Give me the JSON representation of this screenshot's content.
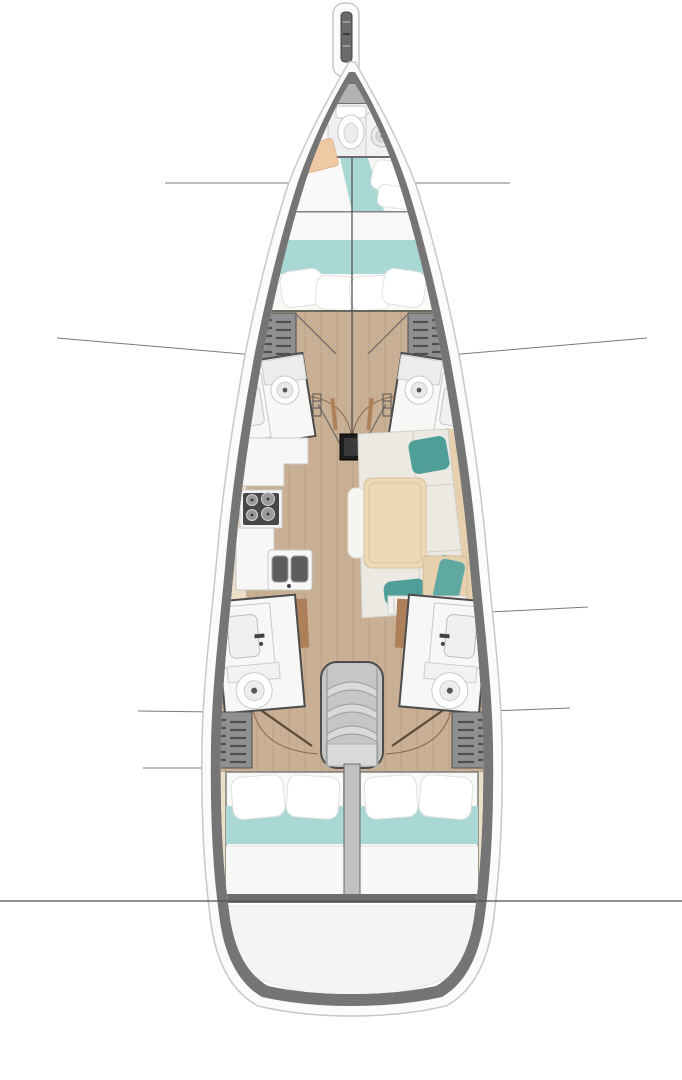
{
  "meta": {
    "title": "Sailing yacht interior layout — top-down floor plan",
    "note": "diagram contains no rendered text"
  },
  "colors": {
    "hull_fill": "#fbfbfb",
    "hull_stroke": "#c8c8c8",
    "gunwale": "#757575",
    "deck": "#9c9c9c",
    "deck_light": "#b2b2b2",
    "wood": "#c9b095",
    "wood_line": "#b89d7f",
    "cream": "#ecdfc8",
    "wall": "#4c4c4c",
    "fixture": "#f7f7f6",
    "fixture_stroke": "#c9c9c9",
    "teal_bed": "#a9d7d3",
    "teal_pillow": "#4f9e97",
    "teal_towel": "#5fa9a1",
    "bed": "#f8f8f7",
    "bed_stroke": "#7e7e7e",
    "pillow": "#ffffff",
    "pillow_stroke": "#e2e2e2",
    "locker": "#8f8f8f",
    "locker_slat": "#4f4f4f",
    "stove": "#474747",
    "burner": "#9a9a9a",
    "table": "#ecd9b8",
    "table_stroke": "#d8c29c",
    "sofa": "#ebe9e2",
    "sofa_seam": "#d0cec5",
    "backrest": "#e6d0ae",
    "peach": "#eec9a4",
    "door_brown": "#ad8059",
    "arc_brown": "#8a6a4f",
    "leaf_brown": "#5c4936",
    "metal": "#d9d9d9",
    "metal_stroke": "#9a9a9a",
    "divider": "#c0c0c0",
    "platform": "#f4f4f4",
    "platform_band": "#858585",
    "line": "#7a7a7a",
    "transom_line": "#4f4f4f",
    "mast": "#1c1c1c",
    "basin_dark": "#5d5d5d"
  },
  "regions": [
    {
      "id": "bowsprit",
      "label": "Anchor roller and bowsprit"
    },
    {
      "id": "foredeck",
      "label": "Foredeck"
    },
    {
      "id": "bow-head",
      "label": "Bow head with shower and toilet"
    },
    {
      "id": "bow-berth",
      "label": "Bow cabin berth"
    },
    {
      "id": "vberth",
      "label": "Forward V-berth cabin"
    },
    {
      "id": "fwd-lockers",
      "label": "Forward wardrobes"
    },
    {
      "id": "head-fwd-port",
      "label": "Forward port head"
    },
    {
      "id": "head-fwd-stbd",
      "label": "Forward starboard head"
    },
    {
      "id": "mast-step",
      "label": "Mast step"
    },
    {
      "id": "galley",
      "label": "Galley with stove and twin sinks"
    },
    {
      "id": "salon-table",
      "label": "Saloon table"
    },
    {
      "id": "salon-sofa",
      "label": "Saloon sofa"
    },
    {
      "id": "companionway",
      "label": "Companionway steps"
    },
    {
      "id": "head-aft-port",
      "label": "Aft port head"
    },
    {
      "id": "head-aft-stbd",
      "label": "Aft starboard head"
    },
    {
      "id": "aft-lockers",
      "label": "Aft wardrobes"
    },
    {
      "id": "cabin-aft-port",
      "label": "Port aft cabin double berth"
    },
    {
      "id": "cabin-aft-stbd",
      "label": "Starboard aft cabin double berth"
    },
    {
      "id": "swim-platform",
      "label": "Stern swim platform"
    }
  ]
}
